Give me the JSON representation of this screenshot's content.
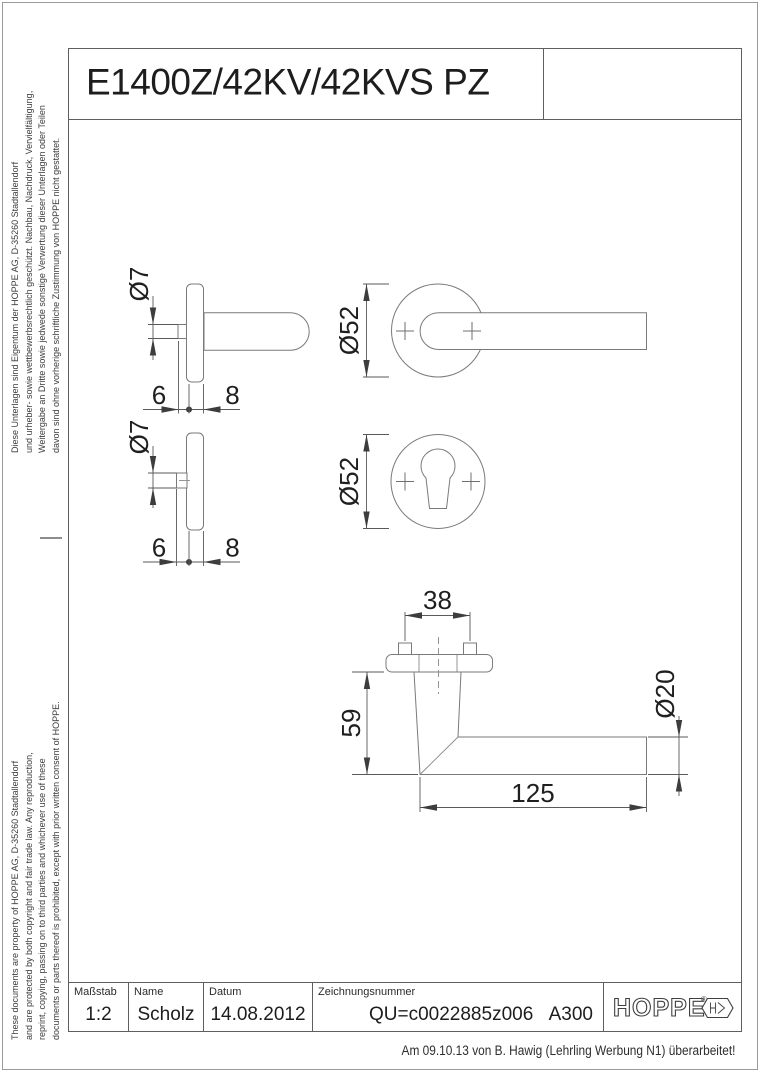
{
  "drawing": {
    "title": "E1400Z/42KV/42KVS PZ",
    "revision_note": "Am 09.10.13 von B. Hawig (Lehrling Werbung N1) überarbeitet!"
  },
  "legal": {
    "german_lines": [
      "Diese Unterlagen sind Eigentum der  HOPPE AG, D-35260 Stadtallendorf",
      "und urheber- sowie wettbewerbsrechtlich geschützt. Nachbau, Nachdruck, Vervielfältigung,",
      "Weitergabe an Dritte sowie jedwede sonstige Verwertung dieser Unterlagen oder Teilen",
      "davon sind ohne vorherige schriftliche Zustimmung von HOPPE nicht gestattet."
    ],
    "english_lines": [
      "These documents are property of HOPPE AG, D-35260 Stadtallendorf",
      "and are protected by both copyright and fair trade law. Any reproduction,",
      "reprint, copying, passing on to third parties and whichever use of these",
      "documents or parts thereof is prohibited, except with prior written consent of HOPPE."
    ]
  },
  "views": {
    "handle_rose_side": {
      "spindle_dia": "Ø7",
      "offset": "6",
      "thickness": "8"
    },
    "handle_front": {
      "rose_dia": "Ø52"
    },
    "escutcheon_side": {
      "spindle_dia": "Ø7",
      "offset": "6",
      "thickness": "8"
    },
    "escutcheon_front": {
      "rose_dia": "Ø52"
    },
    "handle_profile": {
      "stud_spacing": "38",
      "height": "59",
      "grip_dia": "Ø20",
      "length": "125"
    }
  },
  "title_block": {
    "scale_label": "Maßstab",
    "scale": "1:2",
    "name_label": "Name",
    "name": "Scholz",
    "date_label": "Datum",
    "date": "14.08.2012",
    "number_label": "Zeichnungsnummer",
    "number": "QU=c0022885z006",
    "revision": "A300"
  },
  "logo": {
    "brand": "HOPPE",
    "registered": "®"
  }
}
